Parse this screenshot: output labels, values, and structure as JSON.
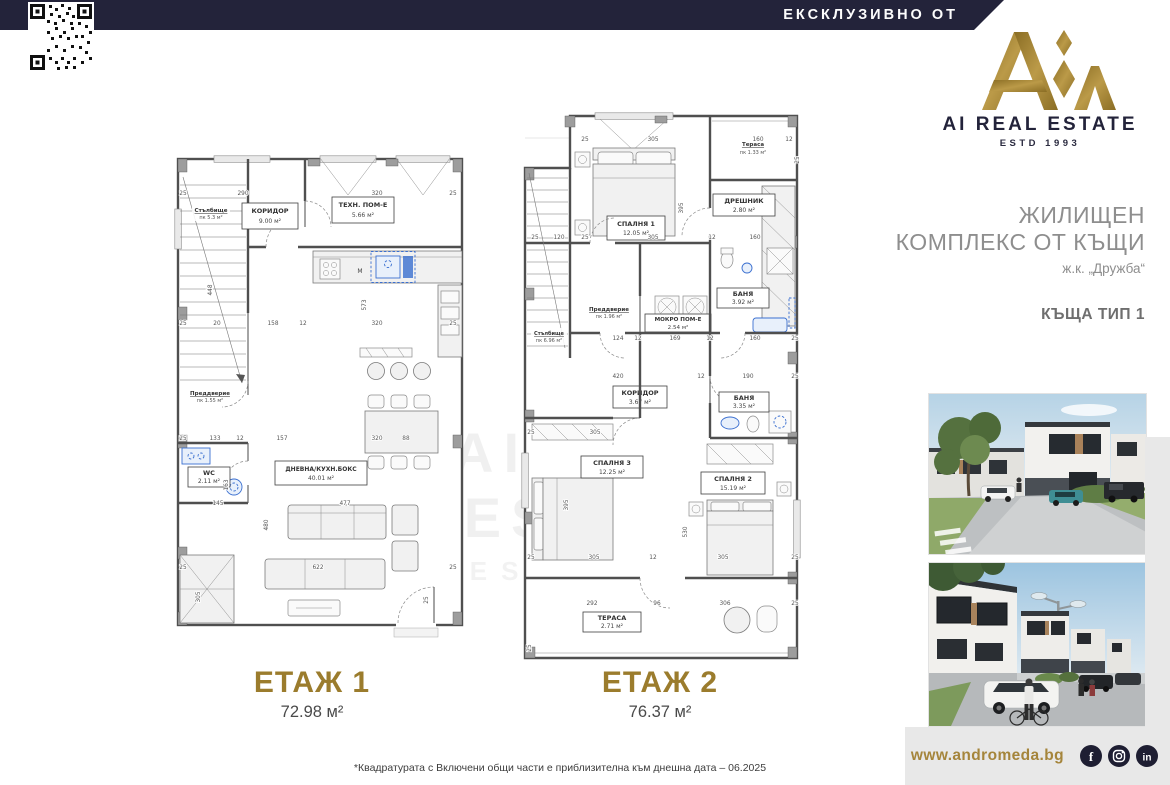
{
  "header": {
    "exclusive": "ЕКСКЛУЗИВНО ОТ"
  },
  "brand": {
    "name": "AI REAL ESTATE",
    "estd": "ESTD 1993"
  },
  "project": {
    "line1": "ЖИЛИЩЕН",
    "line2": "КОМПЛЕКС ОТ КЪЩИ",
    "location": "ж.к. „Дружба“",
    "house_type": "КЪЩА ТИП 1"
  },
  "watermark": {
    "text": "AI REAL ESTATE",
    "sub": "ESTD 1993"
  },
  "floor1": {
    "label": "ЕТАЖ 1",
    "area": "72.98 м²",
    "kitchen_m": "М",
    "rooms": {
      "stairs": {
        "name": "Стълбище",
        "area": "пк 5.3 м²"
      },
      "corridor": {
        "name": "КОРИДОР",
        "area": "9.00 м²"
      },
      "tech": {
        "name": "ТЕХН. ПОМ-Е",
        "area": "5.66 м²"
      },
      "entry": {
        "name": "Преддверие",
        "area": "пк 1.55 м²"
      },
      "wc": {
        "name": "WC",
        "area": "2.11 м²"
      },
      "living": {
        "name": "ДНЕВНА/КУХН.БОКС",
        "area": "40.01 м²"
      }
    },
    "dims": [
      {
        "t": "25",
        "x": 13,
        "y": 50
      },
      {
        "t": "290",
        "x": 73,
        "y": 50
      },
      {
        "t": "320",
        "x": 207,
        "y": 50
      },
      {
        "t": "25",
        "x": 283,
        "y": 50
      },
      {
        "t": "448",
        "x": 42,
        "y": 145,
        "r": -90
      },
      {
        "t": "573",
        "x": 196,
        "y": 160,
        "r": -90
      },
      {
        "t": "25",
        "x": 13,
        "y": 180
      },
      {
        "t": "20",
        "x": 47,
        "y": 180
      },
      {
        "t": "158",
        "x": 103,
        "y": 180
      },
      {
        "t": "12",
        "x": 133,
        "y": 180
      },
      {
        "t": "320",
        "x": 207,
        "y": 180
      },
      {
        "t": "25",
        "x": 283,
        "y": 180
      },
      {
        "t": "25",
        "x": 13,
        "y": 295
      },
      {
        "t": "133",
        "x": 45,
        "y": 295
      },
      {
        "t": "12",
        "x": 70,
        "y": 295
      },
      {
        "t": "157",
        "x": 112,
        "y": 295
      },
      {
        "t": "320",
        "x": 207,
        "y": 295
      },
      {
        "t": "88",
        "x": 236,
        "y": 295
      },
      {
        "t": "163",
        "x": 58,
        "y": 340,
        "r": -90
      },
      {
        "t": "145",
        "x": 48,
        "y": 360
      },
      {
        "t": "477",
        "x": 175,
        "y": 360
      },
      {
        "t": "480",
        "x": 98,
        "y": 380,
        "r": -90
      },
      {
        "t": "305",
        "x": 30,
        "y": 452,
        "r": -90
      },
      {
        "t": "622",
        "x": 148,
        "y": 424
      },
      {
        "t": "25",
        "x": 13,
        "y": 424
      },
      {
        "t": "25",
        "x": 283,
        "y": 424
      },
      {
        "t": "25",
        "x": 258,
        "y": 455,
        "r": -90
      }
    ]
  },
  "floor2": {
    "label": "ЕТАЖ 2",
    "area": "76.37 м²",
    "rooms": {
      "bedroom1": {
        "name": "СПАЛНЯ 1",
        "area": "12.05 м²"
      },
      "terrace_top": {
        "name": "Тераса",
        "area": "пк 1.33 м²"
      },
      "closet": {
        "name": "ДРЕШНИК",
        "area": "2.80 м²"
      },
      "bath1": {
        "name": "БАНЯ",
        "area": "3.92 м²"
      },
      "wet": {
        "name": "МОКРО ПОМ-Е",
        "area": "2.54 м²"
      },
      "entry": {
        "name": "Преддверие",
        "area": "пк 1.96 м²"
      },
      "stairs": {
        "name": "Стълбище",
        "area": "пк 6.96 м²"
      },
      "corridor": {
        "name": "КОРИДОР",
        "area": "3.67 м²"
      },
      "bath2": {
        "name": "БАНЯ",
        "area": "3.35 м²"
      },
      "bedroom3": {
        "name": "СПАЛНЯ 3",
        "area": "12.25 м²"
      },
      "bedroom2": {
        "name": "СПАЛНЯ 2",
        "area": "15.19 м²"
      },
      "terrace": {
        "name": "ТЕРАСА",
        "area": "2.71 м²"
      }
    },
    "dims": [
      {
        "t": "25",
        "x": 80,
        "y": 33
      },
      {
        "t": "305",
        "x": 148,
        "y": 33
      },
      {
        "t": "160",
        "x": 253,
        "y": 33
      },
      {
        "t": "12",
        "x": 284,
        "y": 33
      },
      {
        "t": "395",
        "x": 178,
        "y": 100,
        "r": -90
      },
      {
        "t": "25",
        "x": 294,
        "y": 52,
        "r": -90
      },
      {
        "t": "25",
        "x": 30,
        "y": 131
      },
      {
        "t": "120",
        "x": 54,
        "y": 131
      },
      {
        "t": "25",
        "x": 80,
        "y": 131
      },
      {
        "t": "305",
        "x": 148,
        "y": 131
      },
      {
        "t": "12",
        "x": 207,
        "y": 131
      },
      {
        "t": "160",
        "x": 250,
        "y": 131
      },
      {
        "t": "124",
        "x": 113,
        "y": 232
      },
      {
        "t": "12",
        "x": 133,
        "y": 232
      },
      {
        "t": "169",
        "x": 170,
        "y": 232
      },
      {
        "t": "12",
        "x": 205,
        "y": 232
      },
      {
        "t": "160",
        "x": 250,
        "y": 232
      },
      {
        "t": "25",
        "x": 290,
        "y": 232
      },
      {
        "t": "420",
        "x": 113,
        "y": 270
      },
      {
        "t": "12",
        "x": 196,
        "y": 270
      },
      {
        "t": "190",
        "x": 243,
        "y": 270
      },
      {
        "t": "25",
        "x": 290,
        "y": 270
      },
      {
        "t": "25",
        "x": 26,
        "y": 326
      },
      {
        "t": "305",
        "x": 90,
        "y": 326
      },
      {
        "t": "395",
        "x": 63,
        "y": 397,
        "r": -90
      },
      {
        "t": "530",
        "x": 182,
        "y": 424,
        "r": -90
      },
      {
        "t": "25",
        "x": 26,
        "y": 451
      },
      {
        "t": "305",
        "x": 89,
        "y": 451
      },
      {
        "t": "12",
        "x": 148,
        "y": 451
      },
      {
        "t": "305",
        "x": 218,
        "y": 451
      },
      {
        "t": "25",
        "x": 290,
        "y": 451
      },
      {
        "t": "292",
        "x": 87,
        "y": 497
      },
      {
        "t": "96",
        "x": 152,
        "y": 497
      },
      {
        "t": "306",
        "x": 220,
        "y": 497
      },
      {
        "t": "25",
        "x": 290,
        "y": 497
      },
      {
        "t": "25",
        "x": 26,
        "y": 540,
        "r": -90
      }
    ]
  },
  "footer": {
    "note": "*Квадратурата с Включени общи части е приблизителна към днешна дата – 06.2025",
    "website": "www.andromeda.bg"
  },
  "social": {
    "facebook": "f",
    "linkedin": "in"
  },
  "colors": {
    "navy": "#23233a",
    "gold": "#9b7c2d",
    "panel": "#e8e8e8",
    "fixture_blue": "#3a6fd0"
  }
}
